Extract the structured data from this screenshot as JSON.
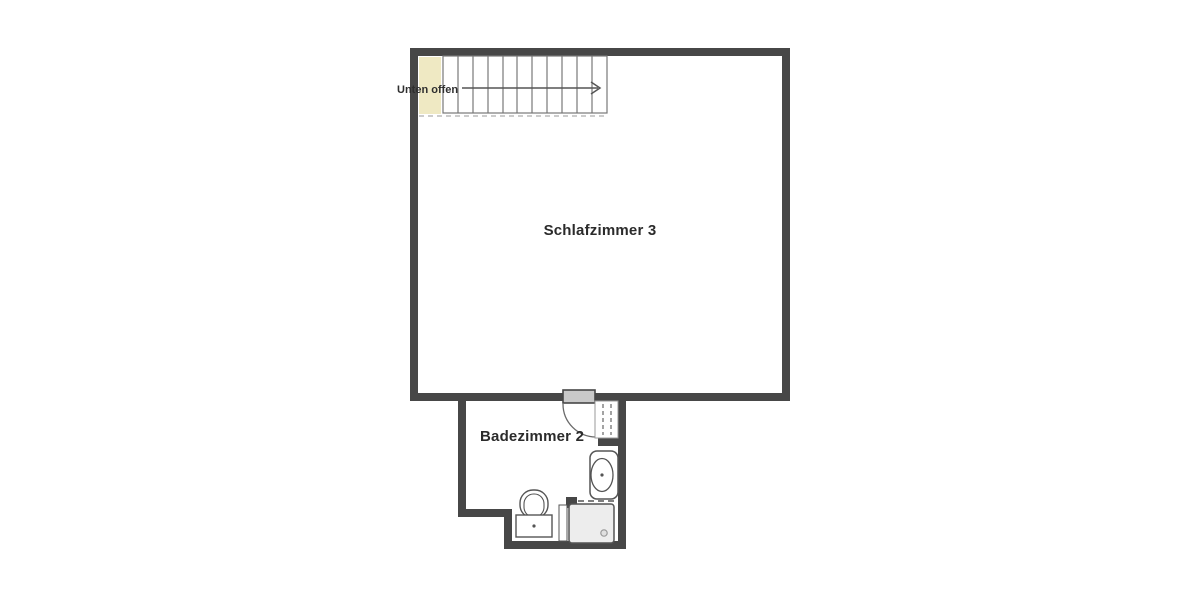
{
  "floor_plan": {
    "title": "floor-plan-upper-level",
    "rooms": [
      {
        "id": "schlafzimmer-3",
        "label": "Schlafzimmer 3"
      },
      {
        "id": "badezimmer-2",
        "label": "Badezimmer 2"
      }
    ],
    "annotations": [
      {
        "id": "unten-offen",
        "label": "Unten offen"
      }
    ],
    "fixtures": [
      "staircase",
      "stair-direction-arrow",
      "open-below-void",
      "swing-door",
      "wardrobe-cabinet",
      "washbasin",
      "toilet",
      "shower"
    ],
    "staircase": {
      "treads": 11,
      "direction": "right"
    },
    "colors": {
      "background": "#ffffff",
      "wall": "#474747",
      "open_below_highlight": "#efe9c3",
      "door_leaf": "#c9c9c9",
      "shower_tray": "#ededed",
      "fixture_line": "#555555",
      "stair_line": "#777777",
      "dashed_line": "#bbbbbb",
      "text": "#2b2b2b"
    }
  }
}
